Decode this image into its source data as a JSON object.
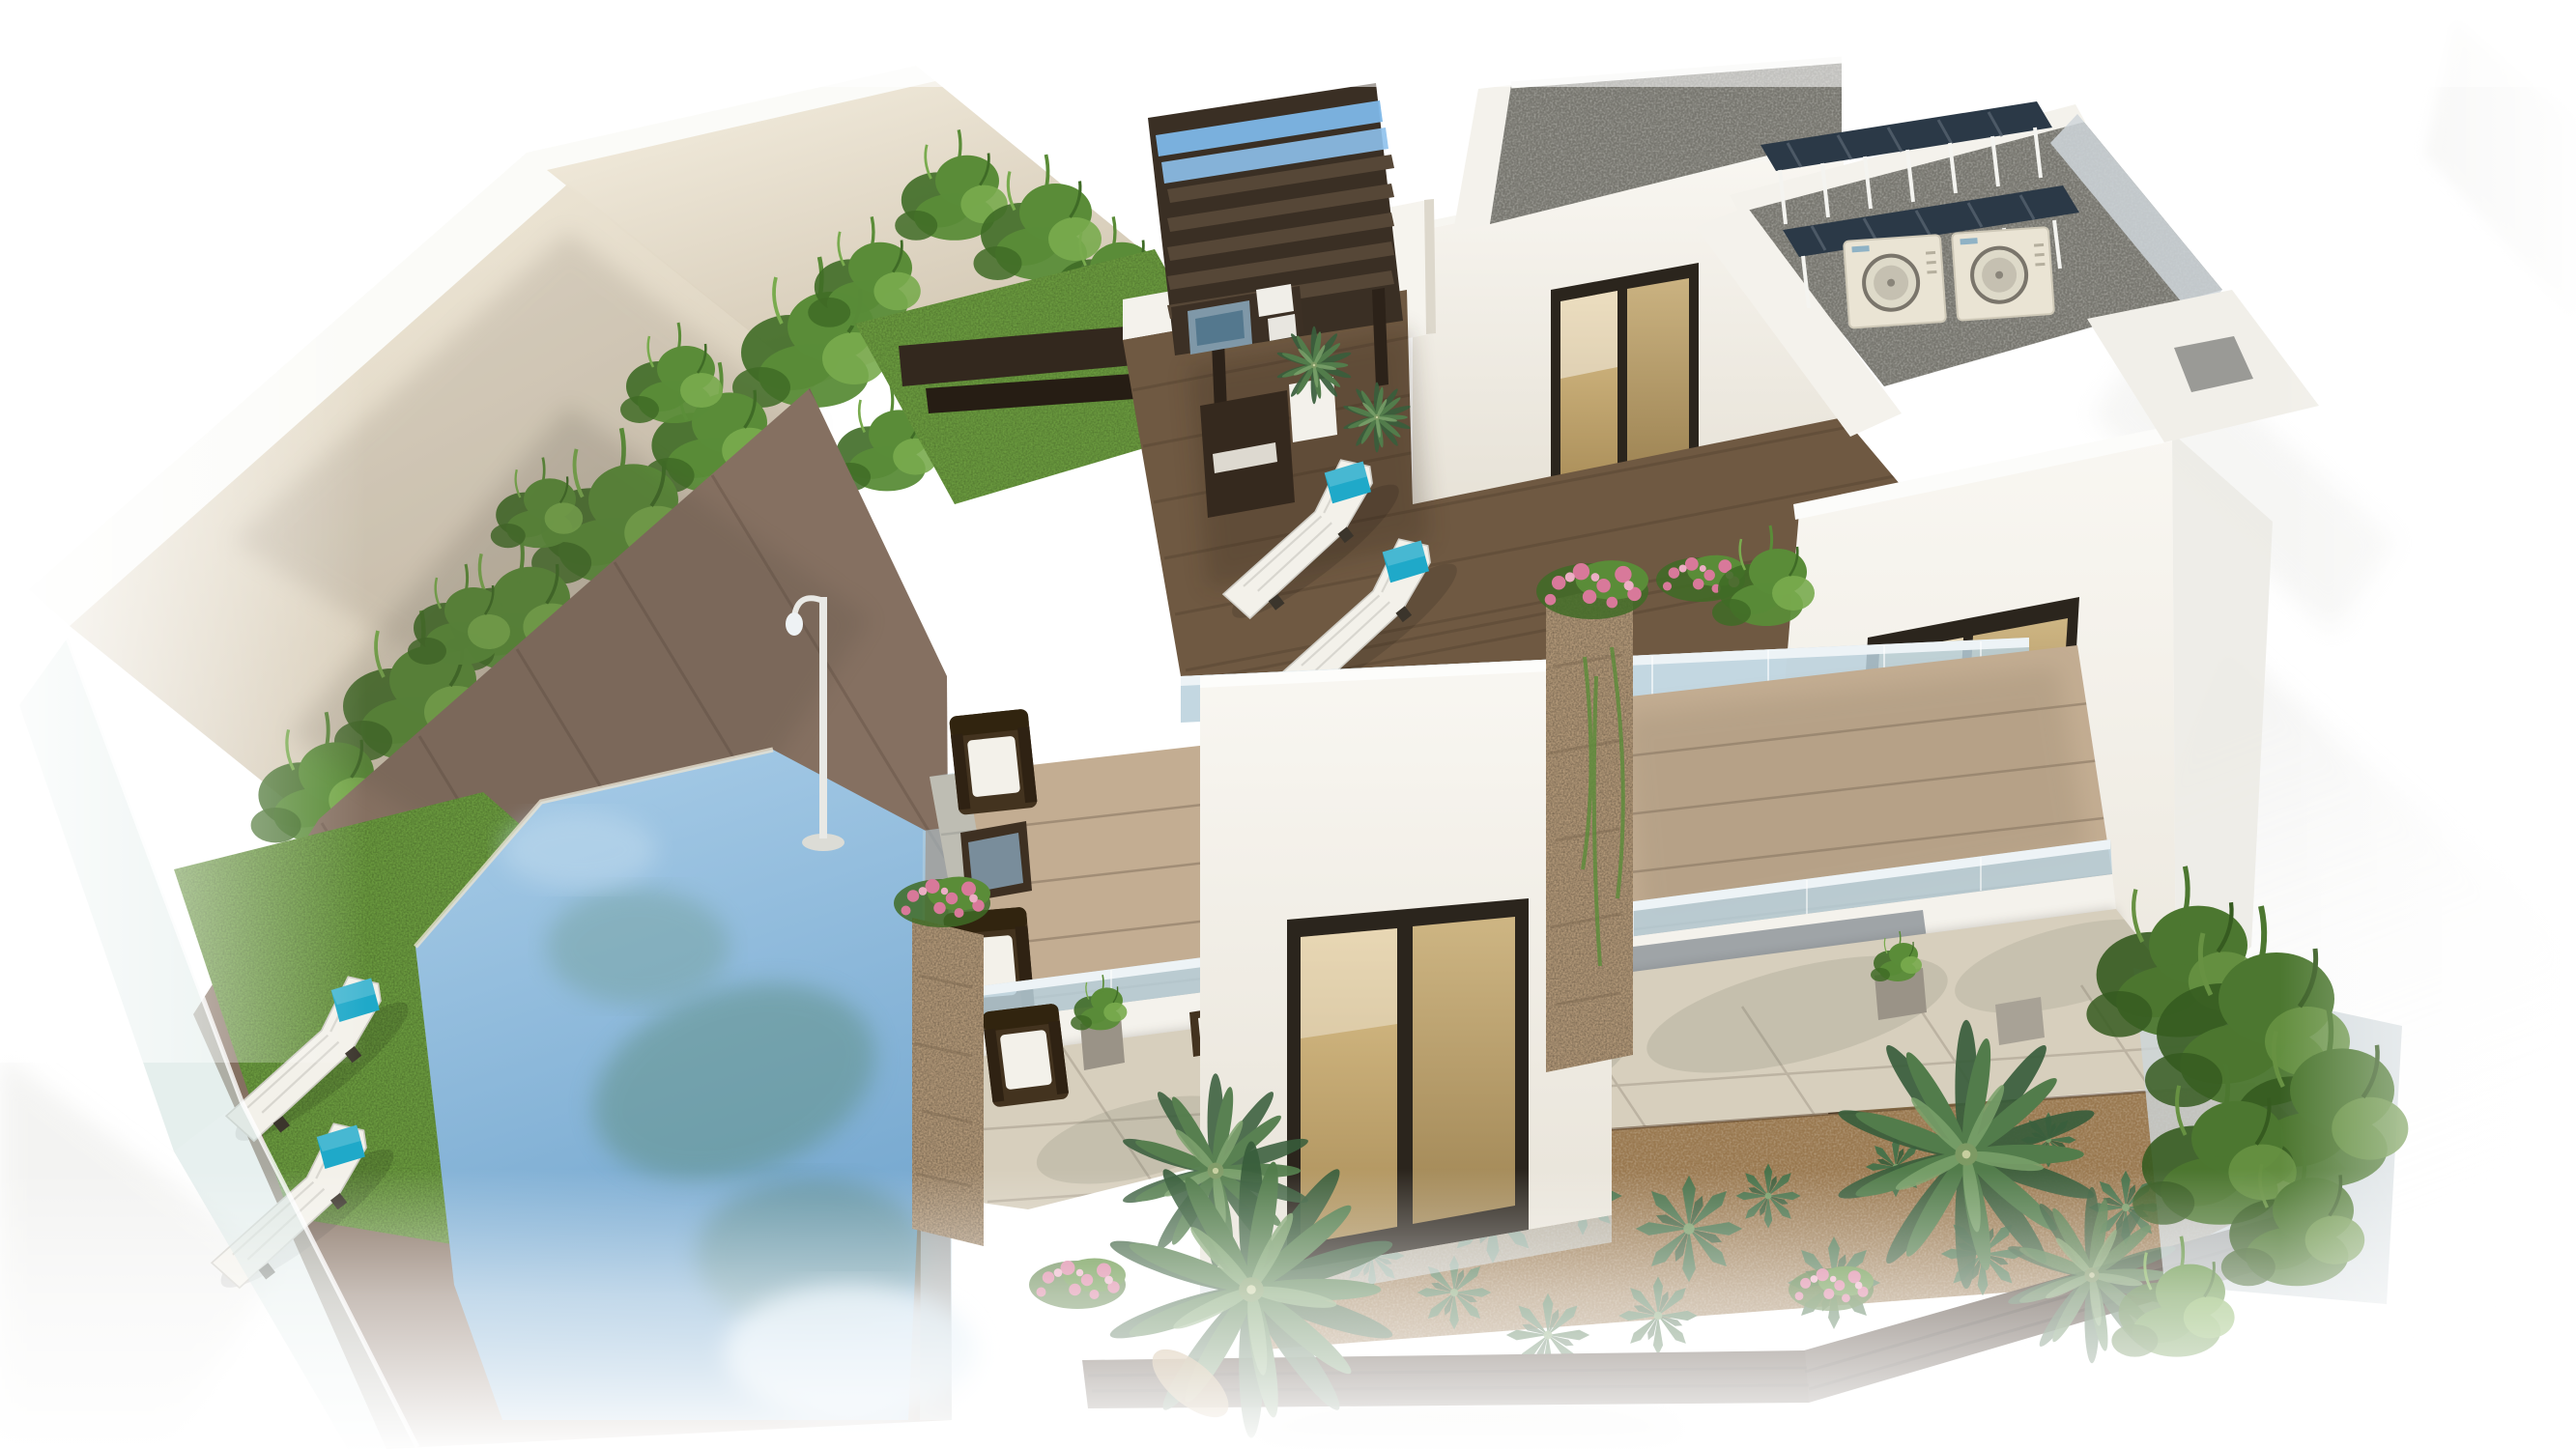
{
  "meta": {
    "content_type": "3D architectural rendering",
    "visible_text": "none",
    "subject": "Aerial view of a modern white multi-storey villa with roof pergola, solar panels, glass balustrades, swimming pool, lawn and desert garden, fading to white at the edges"
  },
  "colors": {
    "background": "#ffffff",
    "ghost": "#e9e9e6",
    "wall_light": "#f6f0e1",
    "wall_shade": "#cfc3ae",
    "wall_edge": "#fbfbf8",
    "vine_main": "#5a8c38",
    "vine_dark": "#3f6b26",
    "vine_light": "#79ab4e",
    "grass": "#6b9b3f",
    "grass_dark": "#49702c",
    "ground_deck": "#857061",
    "roof_deck": "#6f5942",
    "terrace_deck": "#c3ad92",
    "plank_line": "#3c2f22",
    "pergola_frame": "#3a2f24",
    "pergola_slat": "#564737",
    "sky_slat": "#7db7e8",
    "building_white": "#f9f7f2",
    "building_shade": "#e7e2d7",
    "parapet_white": "#f4f2ec",
    "gravel": "#77766f",
    "solar_panel": "#2b3947",
    "frame_white": "#f4f4f0",
    "ac_body": "#eae4d4",
    "ac_fan": "#7a756b",
    "window_frame": "#2b251d",
    "amber_light": "#dcc28c",
    "amber_dark": "#a98d58",
    "glass_rail": "#b8d0dc",
    "glass_cap": "#edf3f6",
    "glass_fence": "#cfe2df",
    "pool_light": "#a9cde8",
    "pool_deep": "#6fa3cc",
    "pool_reflection": "#5f8f82",
    "pool_glow": "#d3e6f3",
    "tile": "#d7cfbd",
    "tile_line": "#b3aa99",
    "shade_tone": "#5f574c",
    "glazing_dark": "#5a6470",
    "mulch": "#99784f",
    "agave": "#49724a",
    "palm_main": "#527c4b",
    "palm_dark": "#395e3c",
    "palm_light": "#7ba26b",
    "stone_pillar": "#b29878",
    "stone_dark": "#7e6a52",
    "flower_pink": "#d8799a",
    "flower_light": "#ecaec4",
    "cushion_teal": "#1fa9c9",
    "wicker": "#43331f",
    "cushion_white": "#f3f1ea",
    "fence_dark": "#39291c",
    "lamp_white": "#e9e9e5",
    "beam_dark": "#33281e",
    "table_glass": "#7f98a8"
  },
  "scene": {
    "label": "Modern villa with pool - aerial render",
    "elements": [
      "perimeter-wall",
      "climbing-vines",
      "lawn",
      "garden-sun-loungers",
      "swimming-pool",
      "pool-glass-fence",
      "wood-deck",
      "garden-lamp",
      "stone-pillars",
      "first-floor-terrace",
      "wicker-furniture",
      "stair-tower",
      "sliding-glass-door",
      "glass-balustrades",
      "roof-terrace",
      "pergola",
      "outdoor-kitchen",
      "roof-sun-loungers",
      "penthouse-volume",
      "gravel-roofs",
      "solar-panel-canopies",
      "ac-units",
      "amber-windows",
      "tower-facade",
      "ground-patio",
      "patio-tiles",
      "desert-garden",
      "agave-plants",
      "palm-trees",
      "flower-bushes",
      "privacy-fence",
      "neighbouring-structures"
    ]
  }
}
